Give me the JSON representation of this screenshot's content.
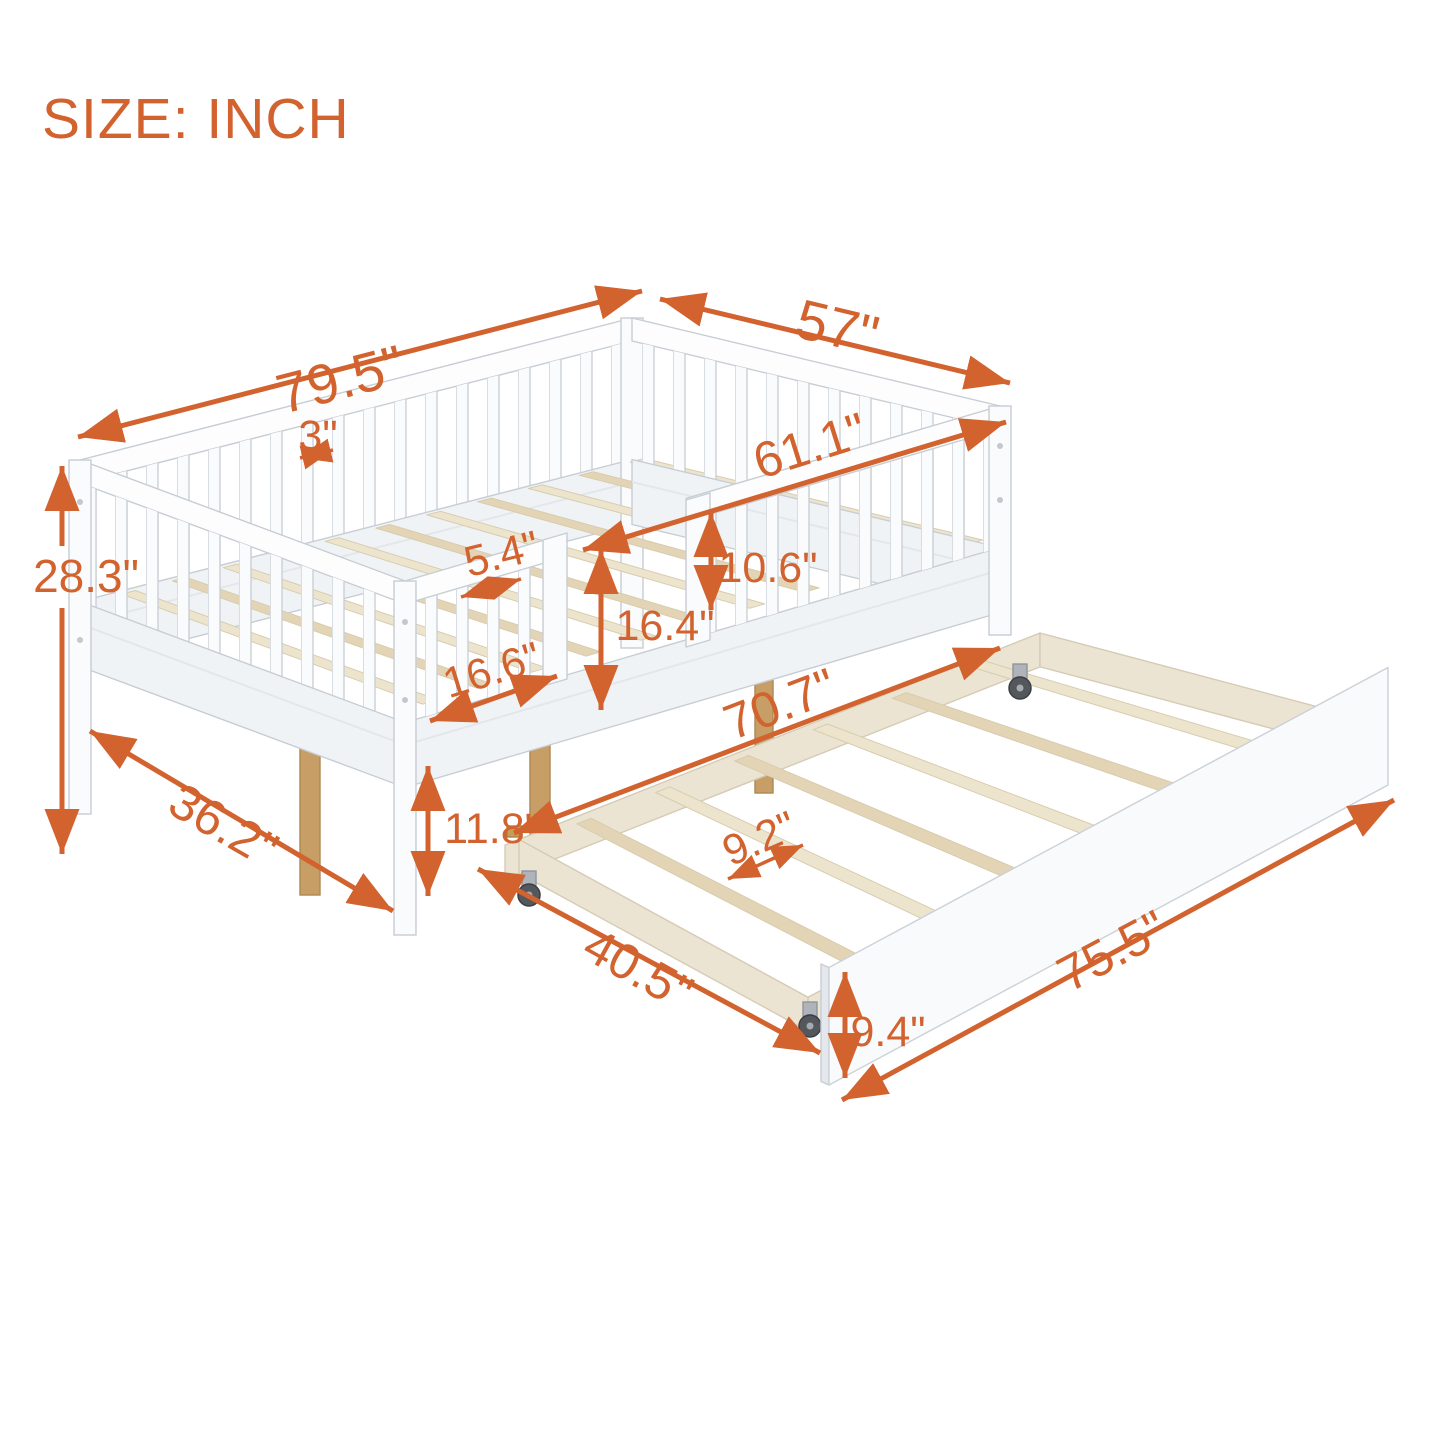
{
  "title": "SIZE: INCH",
  "colors": {
    "accent": "#D2622E",
    "frame": "#FAFBFC",
    "frame_shade": "#F0F3F6",
    "cap": "#FDFDFE",
    "outline": "#C7CDD4",
    "divider": "#E3E7EB",
    "slat_wood": "#EDE4CE",
    "slat_wood_dark": "#E2D4B5",
    "support_wood": "#C79E66",
    "support_wood_edge": "#AE8752",
    "trundle_wood": "#ECE4D2",
    "trundle_wood_edge": "#D5CBB5",
    "caster_wheel": "#54585D",
    "caster_bracket": "#AEB4BA",
    "brass": "#C2A055",
    "screw": "#C2C8CE"
  },
  "diagram": {
    "unit_note": "SIZE: INCH",
    "dimensions": {
      "bed_length": "79.5\"",
      "bed_width": "57\"",
      "rail_slat_gap": "3\"",
      "inner_length": "61.1\"",
      "bed_height": "28.3\"",
      "slat_spacing": "5.4\"",
      "guardrail_above_deck": "10.6\"",
      "guardrail_height": "16.4\"",
      "opening_width": "16.6\"",
      "end_width": "36.2\"",
      "under_bed_clearance": "11.8\"",
      "trundle_inner_length": "70.7\"",
      "trundle_slat_spacing": "9.2\"",
      "trundle_width": "40.5\"",
      "trundle_length": "75.5\"",
      "trundle_panel_height": "9.4\""
    }
  }
}
